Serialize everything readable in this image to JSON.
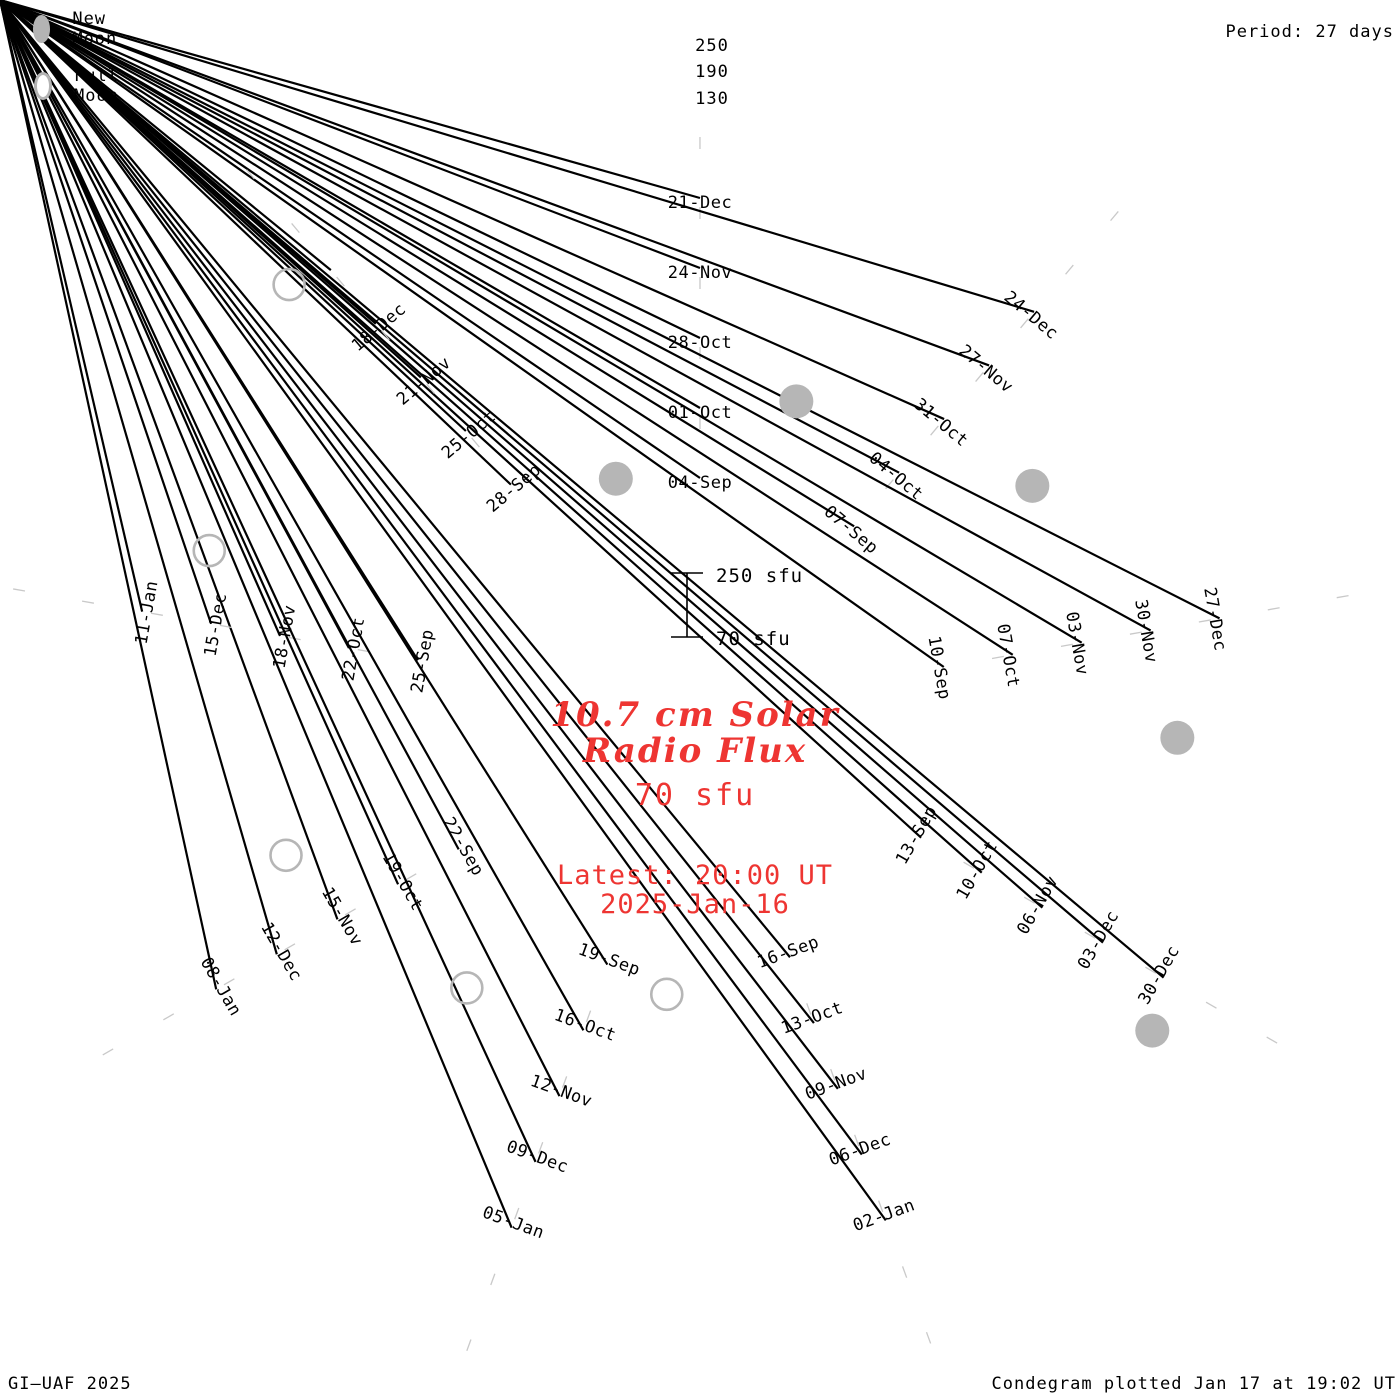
{
  "header": {
    "period_label": "Period: 27 days"
  },
  "legend": {
    "new_moon_label": "New Moon",
    "full_moon_label": "Full Moon",
    "moon_color": "#b4b4b4"
  },
  "footer": {
    "credit": "GI–UAF 2025",
    "plotted": "Condegram plotted Jan 17 at 19:02 UT"
  },
  "center": {
    "title_line1": "10.7 cm Solar",
    "title_line2": "Radio Flux",
    "current_flux": "70 sfu",
    "latest_line1": "Latest: 20:00 UT",
    "latest_line2": "2025-Jan-16",
    "accent_color": "#ee3532"
  },
  "scale": {
    "bar_top_label": "250 sfu",
    "bar_bottom_label": "70 sfu",
    "radial_labels": [
      "250",
      "190",
      "130"
    ]
  },
  "chart_data": {
    "type": "bar",
    "subtype": "condegram-spiral",
    "title": "10.7 cm Solar Radio Flux",
    "units": "sfu",
    "period_days": 27,
    "start_date": "2024-08-31",
    "end_date": "2025-01-16",
    "baseline_sfu": 70,
    "max_ring_sfu": 250,
    "grid_sfu": [
      130,
      190,
      250
    ],
    "geometry": {
      "cx": 700,
      "cy": 710,
      "r0": 240,
      "pitch": 70,
      "ref_day": 4,
      "deg_per_day": 13.3333,
      "sfu_per_pitch": 180,
      "grid_day_end": 166
    },
    "flux_by_day": [
      245,
      250,
      248,
      242,
      235,
      230,
      228,
      230,
      232,
      230,
      226,
      222,
      216,
      205,
      192,
      182,
      175,
      172,
      176,
      184,
      194,
      204,
      214,
      220,
      226,
      231,
      237,
      242,
      246,
      250,
      250,
      250,
      250,
      250,
      250,
      248,
      250,
      250,
      247,
      243,
      237,
      228,
      218,
      208,
      200,
      190,
      180,
      176,
      172,
      168,
      163,
      158,
      157,
      166,
      180,
      199,
      214,
      224,
      228,
      150,
      95,
      75,
      78,
      130,
      240,
      250,
      250,
      250,
      250,
      248,
      244,
      238,
      232,
      228,
      222,
      216,
      211,
      208,
      214,
      224,
      236,
      246,
      250,
      250,
      250,
      250,
      262,
      295,
      330,
      340,
      300,
      235,
      215,
      222,
      230,
      235,
      235,
      230,
      222,
      210,
      196,
      188,
      186,
      192,
      200,
      205,
      172,
      182,
      198,
      215,
      235,
      258,
      278,
      305,
      340,
      375,
      400,
      415,
      422,
      420,
      408,
      390,
      362,
      332,
      308,
      292,
      280,
      268,
      258,
      255,
      257,
      262,
      267,
      272,
      276,
      279,
      281,
      283,
      70
    ],
    "palette_anchors": [
      [
        0,
        "#07030f"
      ],
      [
        6,
        "#120c38"
      ],
      [
        13,
        "#1a1356"
      ],
      [
        19,
        "#241d7e"
      ],
      [
        25,
        "#3135b8"
      ],
      [
        31,
        "#3347cc"
      ],
      [
        37,
        "#3156c9"
      ],
      [
        43,
        "#3a74c0"
      ],
      [
        46,
        "#3d84bc"
      ],
      [
        52,
        "#43a3b3"
      ],
      [
        58,
        "#36b1a7"
      ],
      [
        64,
        "#2eb89c"
      ],
      [
        70,
        "#2fba8a"
      ],
      [
        73,
        "#35bc7d"
      ],
      [
        79,
        "#4fbc54"
      ],
      [
        85,
        "#5cc13e"
      ],
      [
        91,
        "#78c33c"
      ],
      [
        97,
        "#95c538"
      ],
      [
        103,
        "#adbc2e"
      ],
      [
        106,
        "#b4b32a"
      ],
      [
        109,
        "#bda621"
      ],
      [
        112,
        "#c79d15"
      ],
      [
        115,
        "#b5831a"
      ],
      [
        118,
        "#b4781b"
      ],
      [
        121,
        "#ba6a17"
      ],
      [
        124,
        "#bf5f16"
      ],
      [
        127,
        "#c35413"
      ],
      [
        130,
        "#c64811"
      ],
      [
        133,
        "#cb3810"
      ],
      [
        138,
        "#ce2607"
      ]
    ],
    "date_labels": [
      [
        4,
        "04-Sep"
      ],
      [
        7,
        "07-Sep"
      ],
      [
        10,
        "10-Sep"
      ],
      [
        13,
        "13-Sep"
      ],
      [
        16,
        "16-Sep"
      ],
      [
        19,
        "19-Sep"
      ],
      [
        22,
        "22-Sep"
      ],
      [
        25,
        "25-Sep"
      ],
      [
        28,
        "28-Sep"
      ],
      [
        31,
        "01-Oct"
      ],
      [
        34,
        "04-Oct"
      ],
      [
        37,
        "07-Oct"
      ],
      [
        40,
        "10-Oct"
      ],
      [
        43,
        "13-Oct"
      ],
      [
        46,
        "16-Oct"
      ],
      [
        49,
        "19-Oct"
      ],
      [
        52,
        "22-Oct"
      ],
      [
        55,
        "25-Oct"
      ],
      [
        58,
        "28-Oct"
      ],
      [
        61,
        "31-Oct"
      ],
      [
        64,
        "03-Nov"
      ],
      [
        67,
        "06-Nov"
      ],
      [
        70,
        "09-Nov"
      ],
      [
        73,
        "12-Nov"
      ],
      [
        76,
        "15-Nov"
      ],
      [
        79,
        "18-Nov"
      ],
      [
        82,
        "21-Nov"
      ],
      [
        85,
        "24-Nov"
      ],
      [
        88,
        "27-Nov"
      ],
      [
        91,
        "30-Nov"
      ],
      [
        94,
        "03-Dec"
      ],
      [
        97,
        "06-Dec"
      ],
      [
        100,
        "09-Dec"
      ],
      [
        103,
        "12-Dec"
      ],
      [
        106,
        "15-Dec"
      ],
      [
        109,
        "18-Dec"
      ],
      [
        112,
        "21-Dec"
      ],
      [
        115,
        "24-Dec"
      ],
      [
        118,
        "27-Dec"
      ],
      [
        121,
        "30-Dec"
      ],
      [
        124,
        "02-Jan"
      ],
      [
        127,
        "05-Jan"
      ],
      [
        130,
        "08-Jan"
      ],
      [
        133,
        "11-Jan"
      ]
    ],
    "new_moon_days": [
      2.5,
      32.3,
      62.2,
      92.0,
      121.4
    ],
    "full_moon_days": [
      18.0,
      47.5,
      76.8,
      106.6,
      135.7
    ],
    "colors": {
      "grid": "#b9b9b9",
      "day_edge": "#15151a",
      "boundary": "#000000",
      "moon": "#b6b6b6",
      "label": "#000000"
    }
  }
}
